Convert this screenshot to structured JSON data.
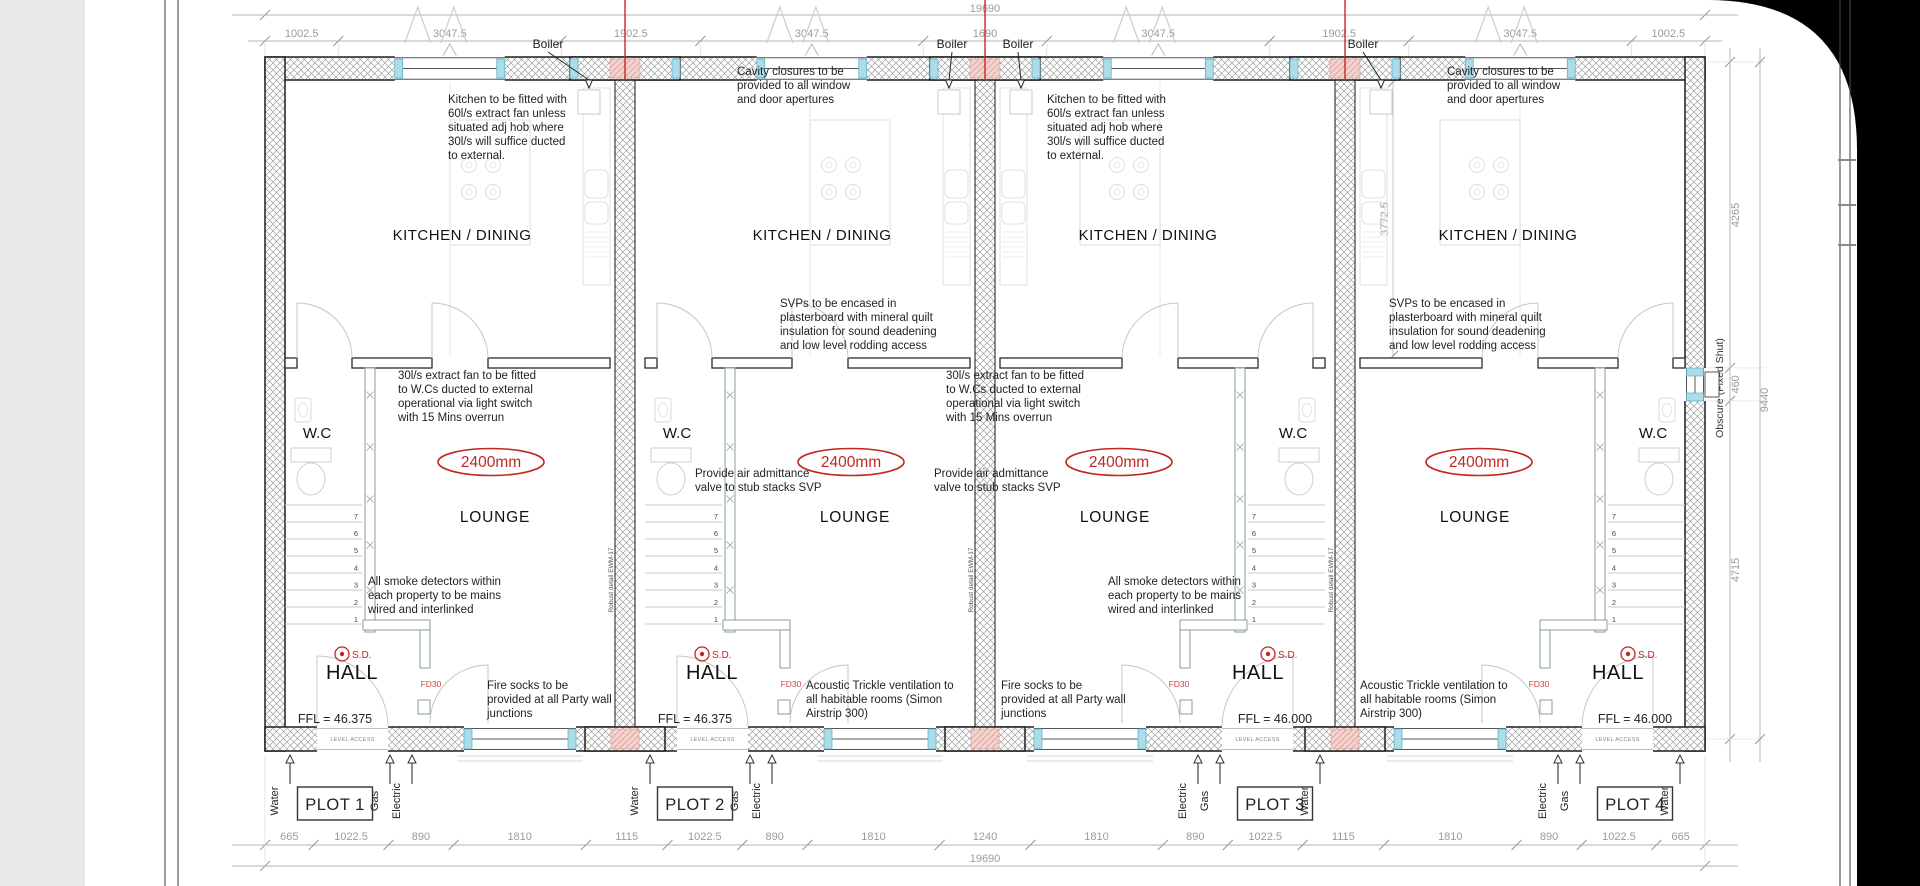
{
  "page": {
    "background": "#000000",
    "panel": "#e8e8e8",
    "paper": "#ffffff"
  },
  "colors": {
    "red": "#c1271f",
    "pink": "#f6d2cd",
    "pink_line": "#e49a90",
    "cyan": "#aadcea",
    "cyan_edge": "#56aec6",
    "dim_text": "#9a9a9a",
    "ink": "#222222",
    "wall_hatch": "#9b9b9b"
  },
  "dimensions": {
    "top_total": "19690",
    "top_segment_labels": [
      "1002.5",
      "3047.5",
      "1902.5",
      "3047.5",
      "1690",
      "3047.5",
      "1902.5",
      "3047.5",
      "1002.5"
    ],
    "top_segment_mm": [
      1002.5,
      3047.5,
      1902.5,
      3047.5,
      1690,
      3047.5,
      1902.5,
      3047.5,
      1002.5
    ],
    "bottom_total": "19690",
    "bottom_segment_labels": [
      "665",
      "1022.5",
      "890",
      "1810",
      "1115",
      "1022.5",
      "890",
      "1810",
      "1240",
      "1810",
      "890",
      "1022.5",
      "1115",
      "1810",
      "890",
      "1022.5",
      "665"
    ],
    "bottom_segment_mm": [
      665,
      1022.5,
      890,
      1810,
      1115,
      1022.5,
      890,
      1810,
      1240,
      1810,
      890,
      1022.5,
      1115,
      1810,
      890,
      1022.5,
      665
    ],
    "right_total": "9440",
    "right_segment_labels": [
      "4265",
      "460",
      "4715"
    ],
    "right_segment_mm": [
      4265,
      460,
      4715
    ],
    "plot4_internal_depth": "3772.5"
  },
  "room_labels": {
    "kitchen": "KITCHEN / DINING",
    "lounge": "LOUNGE",
    "wc": "W.C",
    "hall": "HALL"
  },
  "symbols": {
    "boiler": "Boiler",
    "smoke_detector": "S.D.",
    "fire_door": "FD30",
    "level_access": "LEVEL ACCESS",
    "ceiling_height": "2400mm",
    "robust_detail": "Robust detail EWM-17",
    "obscure_window": "Obscure (Fixed Shut)",
    "stair_numbers": [
      "1",
      "2",
      "3",
      "4",
      "5",
      "6",
      "7"
    ]
  },
  "plots": [
    {
      "name": "PLOT 1",
      "ffl": "FFL = 46.375"
    },
    {
      "name": "PLOT 2",
      "ffl": "FFL = 46.375"
    },
    {
      "name": "PLOT 3",
      "ffl": "FFL = 46.000"
    },
    {
      "name": "PLOT 4",
      "ffl": "FFL = 46.000"
    }
  ],
  "utilities": [
    "Water",
    "Gas",
    "Electric"
  ],
  "annotations": [
    {
      "id": "kitchen-fan-plot1",
      "x": 448,
      "y": 92,
      "lines": [
        "Kitchen to be fitted with",
        "60l/s extract fan unless",
        "situated adj hob where",
        "30l/s will suffice ducted",
        "to external."
      ]
    },
    {
      "id": "kitchen-fan-plot3",
      "x": 1047,
      "y": 92,
      "lines": [
        "Kitchen to be fitted with",
        "60l/s extract fan unless",
        "situated adj hob where",
        "30l/s will suffice ducted",
        "to external."
      ]
    },
    {
      "id": "cavity-plot2",
      "x": 737,
      "y": 64,
      "lines": [
        "Cavity closures to be",
        "provided to all window",
        "and door apertures"
      ]
    },
    {
      "id": "cavity-plot4",
      "x": 1447,
      "y": 64,
      "lines": [
        "Cavity closures to be",
        "provided to all window",
        "and door apertures"
      ]
    },
    {
      "id": "svp-plot2",
      "x": 780,
      "y": 296,
      "lines": [
        "SVPs to be encased in",
        "plasterboard with mineral quilt",
        "insulation for sound deadening",
        "and low level rodding access"
      ]
    },
    {
      "id": "svp-plot4",
      "x": 1389,
      "y": 296,
      "lines": [
        "SVPs to be encased in",
        "plasterboard with mineral quilt",
        "insulation for sound deadening",
        "and low level rodding access"
      ]
    },
    {
      "id": "wcfan-plot1",
      "x": 398,
      "y": 368,
      "lines": [
        "30l/s extract fan to be fitted",
        "to W.Cs ducted to external",
        "operational via light switch",
        "with 15 Mins overrun"
      ]
    },
    {
      "id": "wcfan-plot3",
      "x": 946,
      "y": 368,
      "lines": [
        "30l/s extract fan to be fitted",
        "to W.Cs ducted to external",
        "operational via light switch",
        "with 15 Mins overrun"
      ]
    },
    {
      "id": "aav-plot2",
      "x": 695,
      "y": 466,
      "lines": [
        "Provide air admittance",
        "valve to stub stacks SVP"
      ]
    },
    {
      "id": "aav-plot3",
      "x": 934,
      "y": 466,
      "lines": [
        "Provide air admittance",
        "valve to stub stacks SVP"
      ]
    },
    {
      "id": "smoke-plot1",
      "x": 368,
      "y": 574,
      "lines": [
        "All smoke detectors within",
        "each property to be mains",
        "wired and interlinked"
      ]
    },
    {
      "id": "smoke-plot3",
      "x": 1108,
      "y": 574,
      "lines": [
        "All smoke detectors within",
        "each property to be mains",
        "wired and interlinked"
      ]
    },
    {
      "id": "firesocks-plot1",
      "x": 487,
      "y": 678,
      "lines": [
        "Fire socks to be",
        "provided at all Party wall",
        "junctions"
      ]
    },
    {
      "id": "firesocks-plot3",
      "x": 1001,
      "y": 678,
      "lines": [
        "Fire socks to be",
        "provided at all Party wall",
        "junctions"
      ]
    },
    {
      "id": "acoustic-plot2",
      "x": 806,
      "y": 678,
      "lines": [
        "Acoustic Trickle ventilation to",
        "all habitable rooms (Simon",
        "Airstrip 300)"
      ]
    },
    {
      "id": "acoustic-plot4",
      "x": 1360,
      "y": 678,
      "lines": [
        "Acoustic Trickle ventilation to",
        "all habitable rooms (Simon",
        "Airstrip 300)"
      ]
    }
  ]
}
